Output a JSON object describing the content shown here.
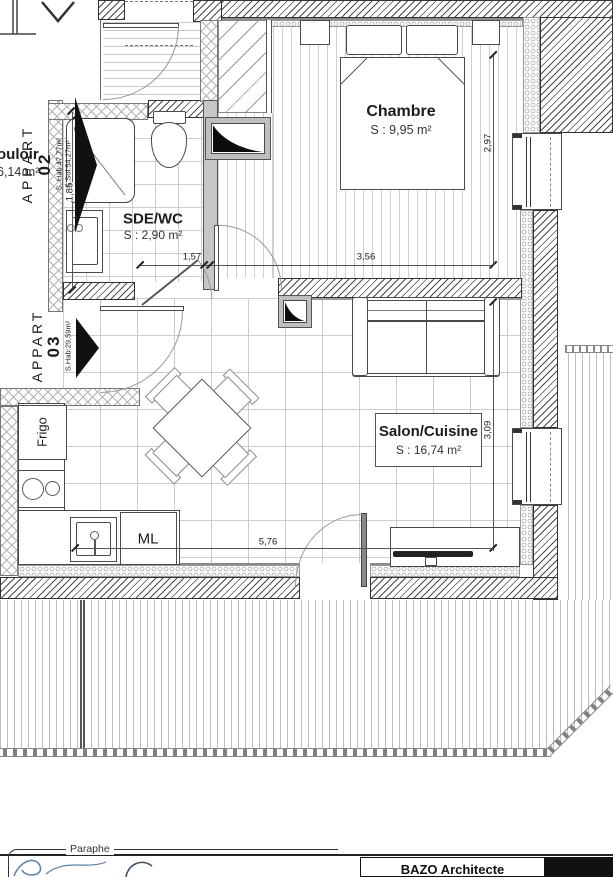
{
  "labels": {
    "apart02": {
      "title": "APPART",
      "number": "02",
      "hab": "S. Hab:47,77m²",
      "sol": "S.Sol:54,27m²"
    },
    "apart03": {
      "title": "APPART",
      "number": "03",
      "hab": "S.Hab:29,59m²"
    },
    "couloir": {
      "name": "ouloir",
      "area": "6,14 m²"
    },
    "chambre": {
      "name": "Chambre",
      "area": "S : 9,95 m²"
    },
    "sde": {
      "name": "SDE/WC",
      "area": "S : 2,90 m²"
    },
    "salon": {
      "name": "Salon/Cuisine",
      "area": "S : 16,74 m²"
    },
    "frigo": "Frigo",
    "ml": "ML"
  },
  "dimensions": {
    "sde_width": "1,57",
    "chambre_width": "3,56",
    "chambre_depth": "2,97",
    "salon_depth": "3,09",
    "salon_width": "5,76",
    "sde_depth": "1,85"
  },
  "titleblock": {
    "paraphe": "Paraphe",
    "architect": "BAZO Architecte"
  },
  "colors": {
    "wall_line": "#4a4a4a",
    "black": "#111111",
    "signature_blue": "#5b7fa6"
  }
}
